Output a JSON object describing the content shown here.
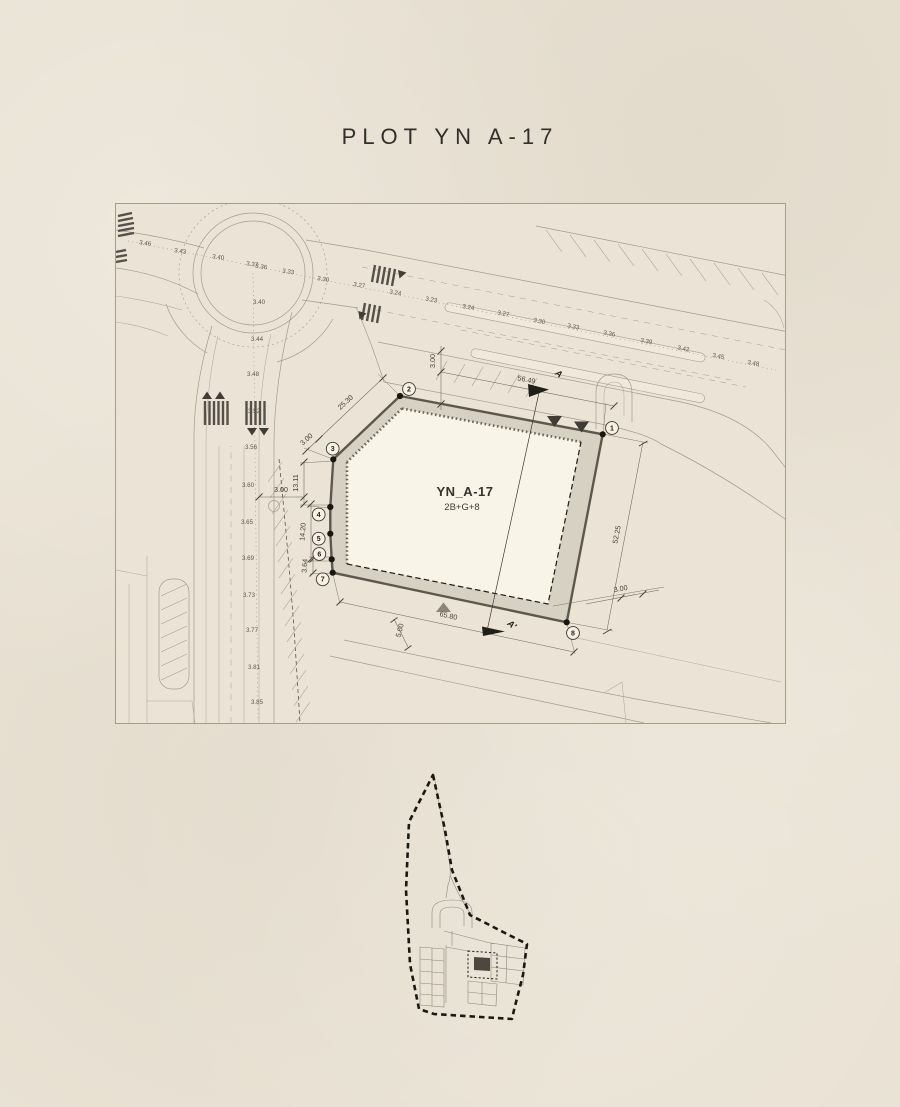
{
  "title": "PLOT YN A-17",
  "colors": {
    "background": "#e9e2d4",
    "title_text": "#312f2a",
    "plot_band": "#d7d1c3",
    "plot_interior": "#f9f4e8",
    "plot_outline": "#5d584e",
    "line": "#a49b8c",
    "dimension_text": "#46412f",
    "spot_level_text": "#5e574a",
    "key_map_highlight": "#4c4840"
  },
  "drawing": {
    "plot": {
      "name": "YN_A-17",
      "storeys": "2B+G+8"
    },
    "vertices": [
      {
        "n": "1",
        "cx": 496,
        "cy": 224,
        "dx": 486.7,
        "dy": 230.3
      },
      {
        "n": "2",
        "cx": 293,
        "cy": 185,
        "dx": 284,
        "dy": 192
      },
      {
        "n": "3",
        "cx": 216.7,
        "cy": 244.7,
        "dx": 217.3,
        "dy": 255.3
      },
      {
        "n": "4",
        "cx": 202.7,
        "cy": 310.5,
        "dx": 214.3,
        "dy": 303
      },
      {
        "n": "5",
        "cx": 202.7,
        "cy": 334.7,
        "dx": 214.3,
        "dy": 329.7
      },
      {
        "n": "6",
        "cx": 203.3,
        "cy": 350,
        "dx": 215.7,
        "dy": 355.3
      },
      {
        "n": "7",
        "cx": 206.7,
        "cy": 375.3,
        "dx": 216.7,
        "dy": 368.7
      },
      {
        "n": "8",
        "cx": 457,
        "cy": 429,
        "dx": 450.7,
        "dy": 418.3
      }
    ],
    "dimensions": [
      {
        "text": "56.49",
        "x": 410,
        "y": 178,
        "rot": 11
      },
      {
        "text": "3.00",
        "x": 319,
        "y": 157,
        "rot": -90
      },
      {
        "text": "25.30",
        "x": 231,
        "y": 200,
        "rot": -43
      },
      {
        "text": "3.00",
        "x": 192,
        "y": 237,
        "rot": -43
      },
      {
        "text": "13.11",
        "x": 182,
        "y": 279,
        "rot": -90
      },
      {
        "text": "3.00",
        "x": 165,
        "y": 288,
        "rot": 0
      },
      {
        "text": "14.20",
        "x": 189,
        "y": 328,
        "rot": -86
      },
      {
        "text": "3.64",
        "x": 191,
        "y": 362,
        "rot": -86
      },
      {
        "text": "5.00",
        "x": 286,
        "y": 427,
        "rot": -75
      },
      {
        "text": "65.80",
        "x": 332,
        "y": 414,
        "rot": 12
      },
      {
        "text": "52.25",
        "x": 503,
        "y": 331,
        "rot": -79
      },
      {
        "text": "3.00",
        "x": 505,
        "y": 387,
        "rot": -10
      }
    ],
    "section_markers": [
      {
        "text": "A",
        "x": 441,
        "y": 172,
        "rot": 38
      },
      {
        "text": "A'",
        "x": 394,
        "y": 423,
        "rot": 38
      }
    ],
    "spot_levels": {
      "main_line": [
        {
          "v": "3.46",
          "x": 29,
          "y": 41,
          "r": 8
        },
        {
          "v": "3.43",
          "x": 64,
          "y": 49,
          "r": 8
        },
        {
          "v": "3.40",
          "x": 102,
          "y": 55,
          "r": 8
        },
        {
          "v": "3.37",
          "x": 136,
          "y": 62,
          "r": 8
        },
        {
          "v": "3.36",
          "x": 145,
          "y": 64.5,
          "r": 8
        },
        {
          "v": "3.33",
          "x": 172,
          "y": 69.5,
          "r": 8
        },
        {
          "v": "3.30",
          "x": 207,
          "y": 77,
          "r": 9
        },
        {
          "v": "3.27",
          "x": 243,
          "y": 83,
          "r": 9
        },
        {
          "v": "3.24",
          "x": 279,
          "y": 90.5,
          "r": 10
        },
        {
          "v": "3.23",
          "x": 315,
          "y": 97.5,
          "r": 10
        },
        {
          "v": "3.24",
          "x": 352,
          "y": 105,
          "r": 10
        },
        {
          "v": "3.27",
          "x": 387,
          "y": 111.5,
          "r": 10
        },
        {
          "v": "3.30",
          "x": 423,
          "y": 119,
          "r": 11
        },
        {
          "v": "3.33",
          "x": 457,
          "y": 124.5,
          "r": 11
        },
        {
          "v": "3.36",
          "x": 493,
          "y": 131.5,
          "r": 11
        },
        {
          "v": "3.39",
          "x": 530,
          "y": 139,
          "r": 11
        },
        {
          "v": "3.42",
          "x": 567,
          "y": 146.5,
          "r": 11
        },
        {
          "v": "3.45",
          "x": 602,
          "y": 154,
          "r": 11
        },
        {
          "v": "3.48",
          "x": 637,
          "y": 161,
          "r": 11
        }
      ],
      "roundabout": [
        {
          "v": "3.40",
          "x": 143,
          "y": 100,
          "r": 0
        },
        {
          "v": "3.44",
          "x": 141,
          "y": 137,
          "r": 0
        }
      ],
      "south_road": [
        {
          "v": "3.48",
          "x": 137,
          "y": 172,
          "r": 0
        },
        {
          "v": "3.52",
          "x": 138,
          "y": 209,
          "r": 0
        },
        {
          "v": "3.56",
          "x": 135,
          "y": 245,
          "r": 0
        },
        {
          "v": "3.60",
          "x": 132,
          "y": 283,
          "r": 0
        },
        {
          "v": "3.65",
          "x": 131,
          "y": 320,
          "r": 0
        },
        {
          "v": "3.69",
          "x": 132,
          "y": 356,
          "r": 0
        },
        {
          "v": "3.73",
          "x": 133,
          "y": 393,
          "r": 0
        },
        {
          "v": "3.77",
          "x": 136,
          "y": 428,
          "r": 0
        },
        {
          "v": "3.81",
          "x": 138,
          "y": 465,
          "r": 0
        },
        {
          "v": "3.85",
          "x": 141,
          "y": 500,
          "r": 0
        }
      ]
    }
  }
}
